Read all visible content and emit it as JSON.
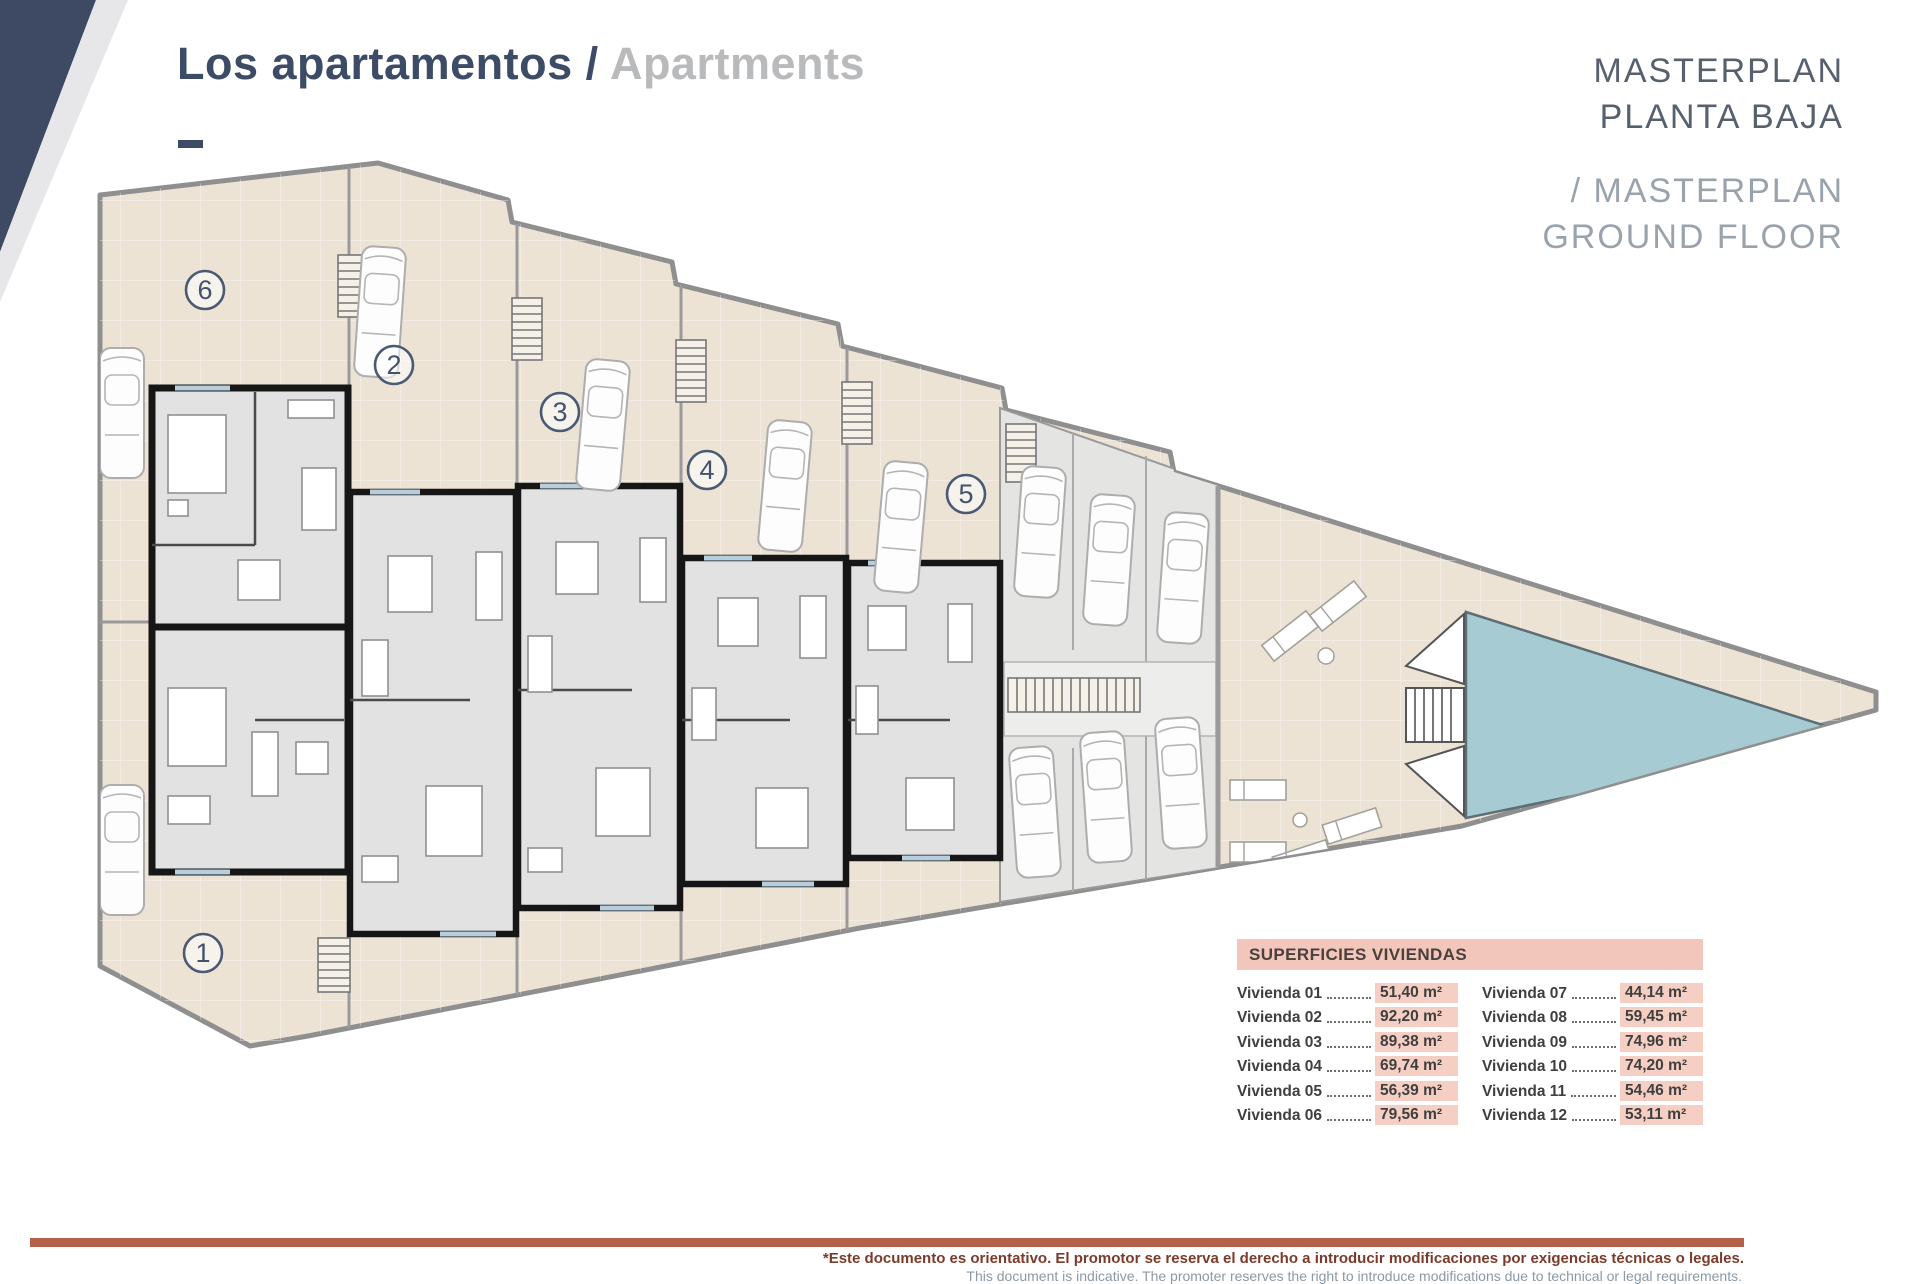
{
  "header": {
    "title_primary": "Los apartamentos /",
    "title_secondary": " Apartments",
    "dash": ""
  },
  "masterplan": {
    "line1": "MASTERPLAN",
    "line2": "PLANTA BAJA",
    "line3": "/ MASTERPLAN",
    "line4": "GROUND FLOOR"
  },
  "plan": {
    "units": [
      {
        "label": "1"
      },
      {
        "label": "2"
      },
      {
        "label": "3"
      },
      {
        "label": "4"
      },
      {
        "label": "5"
      },
      {
        "label": "6"
      }
    ]
  },
  "areas_table": {
    "title": "SUPERFICIES VIVIENDAS",
    "left": [
      {
        "label": "Vivienda 01",
        "value": "51,40 m²"
      },
      {
        "label": "Vivienda 02",
        "value": "92,20 m²"
      },
      {
        "label": "Vivienda 03",
        "value": "89,38 m²"
      },
      {
        "label": "Vivienda 04",
        "value": "69,74 m²"
      },
      {
        "label": "Vivienda 05",
        "value": "56,39 m²"
      },
      {
        "label": "Vivienda 06",
        "value": "79,56 m²"
      }
    ],
    "right": [
      {
        "label": "Vivienda 07",
        "value": "44,14 m²"
      },
      {
        "label": "Vivienda 08",
        "value": "59,45 m²"
      },
      {
        "label": "Vivienda 09",
        "value": "74,96 m²"
      },
      {
        "label": "Vivienda 10",
        "value": "74,20 m²"
      },
      {
        "label": "Vivienda 11",
        "value": "54,46 m²"
      },
      {
        "label": "Vivienda 12",
        "value": "53,11 m²"
      }
    ]
  },
  "footer": {
    "disclaimer_es": "*Este documento es orientativo. El promotor se reserva el derecho a introducir modificaciones por exigencias técnicas o legales.",
    "disclaimer_en": "This document is indicative. The promoter reserves the right to introduce modifications due to technical or legal requirements."
  },
  "colors": {
    "accent_navy": "#3c4b66",
    "masterplan_dark": "#57616e",
    "masterplan_light": "#9aa3ac",
    "panel_pink": "#f2c6ba",
    "value_pink": "#f5cfc3",
    "footer_bar": "#b4614b",
    "disclaimer_red": "#7c3b2a",
    "pool_teal": "#a7cbd3",
    "plan_beige": "#ece3d5"
  }
}
